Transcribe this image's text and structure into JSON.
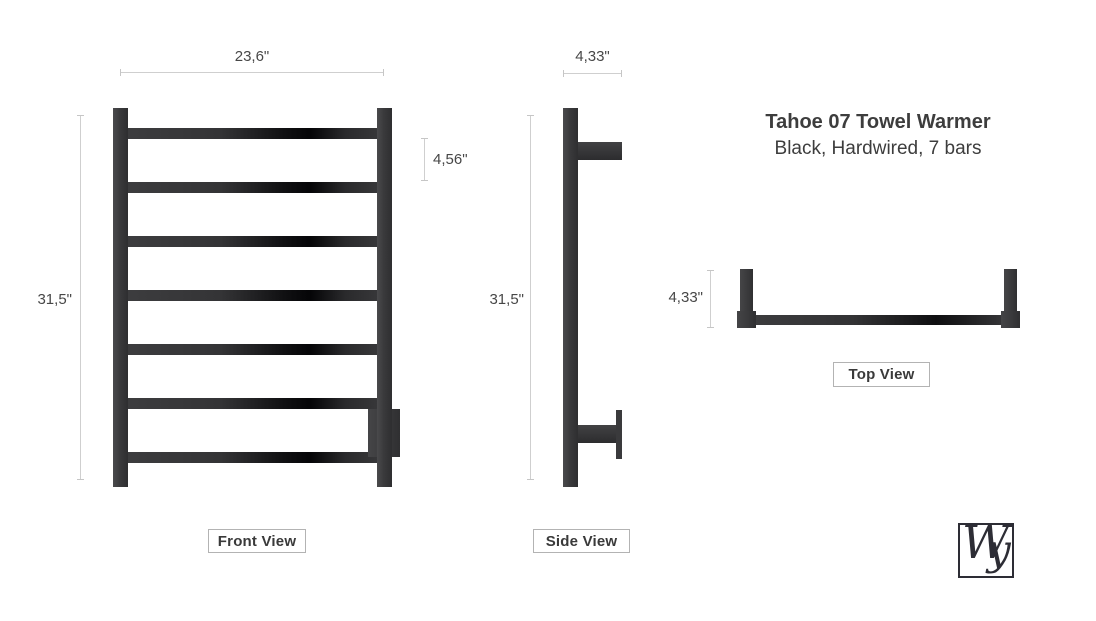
{
  "title": {
    "line1": "Tahoe 07 Towel Warmer",
    "line2": "Black, Hardwired, 7 bars"
  },
  "views": {
    "front": {
      "label": "Front View",
      "width_dim": "23,6\"",
      "height_dim": "31,5\"",
      "bar_spacing_dim": "4,56\"",
      "bar_count": 7
    },
    "side": {
      "label": "Side View",
      "depth_dim": "4,33\"",
      "height_dim": "31,5\""
    },
    "top": {
      "label": "Top View",
      "depth_dim": "4,33\""
    }
  },
  "logo": {
    "letter_w": "W",
    "letter_y": "y"
  },
  "colors": {
    "metal_dark": "#3a3a3c",
    "metal_black": "#0c0c0e",
    "dimension_line": "#cfcfcf",
    "text": "#3f3f3f",
    "label_border": "#b3b3b3"
  }
}
